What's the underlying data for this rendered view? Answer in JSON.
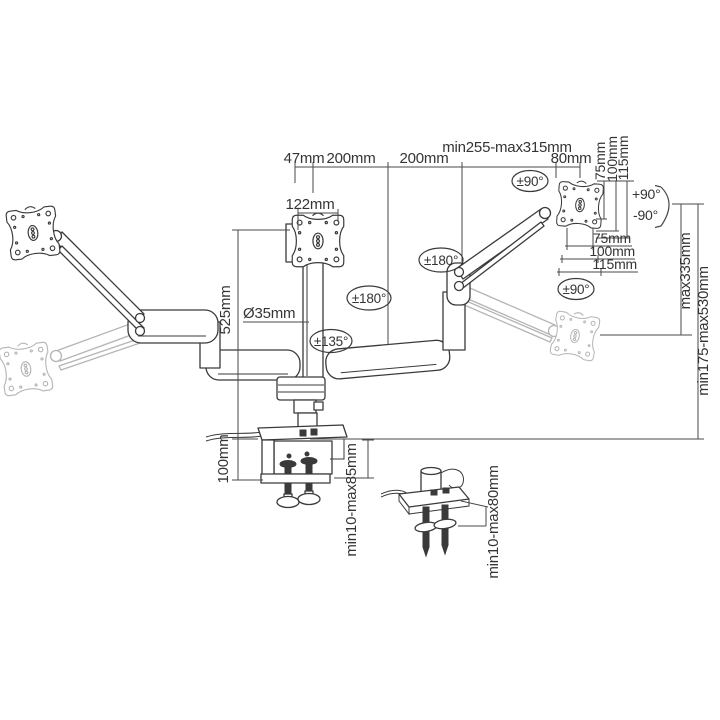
{
  "colors": {
    "line": "#3a3a3a",
    "dimension": "#4a4a4a",
    "ghost": "#b5b5b5",
    "background": "#ffffff",
    "text": "#343434"
  },
  "dimensions": {
    "pole_offset": "47mm",
    "reach_left": "200mm",
    "reach_right": "200mm",
    "reach_range": "min255-max315mm",
    "end_offset": "80mm",
    "head_offset": "122mm",
    "pole_height": "525mm",
    "pole_diameter": "Ø35mm",
    "clamp_height": "100mm",
    "clamp_range": "min10-max85mm",
    "grommet_range": "min10-max80mm",
    "raise_max": "max335mm",
    "height_range": "min175-max530mm",
    "vesa_vertical": [
      "75mm",
      "100mm",
      "115mm"
    ],
    "vesa_horizontal": [
      "75mm",
      "100mm",
      "115mm"
    ]
  },
  "angles": {
    "head_swivel_top": "±90°",
    "tilt_up": "+90°",
    "tilt_down": "-90°",
    "elbow_swivel_right": "±180°",
    "elbow_swivel_left": "±180°",
    "head_rotate_right": "±90°",
    "base_swivel": "±135°"
  }
}
